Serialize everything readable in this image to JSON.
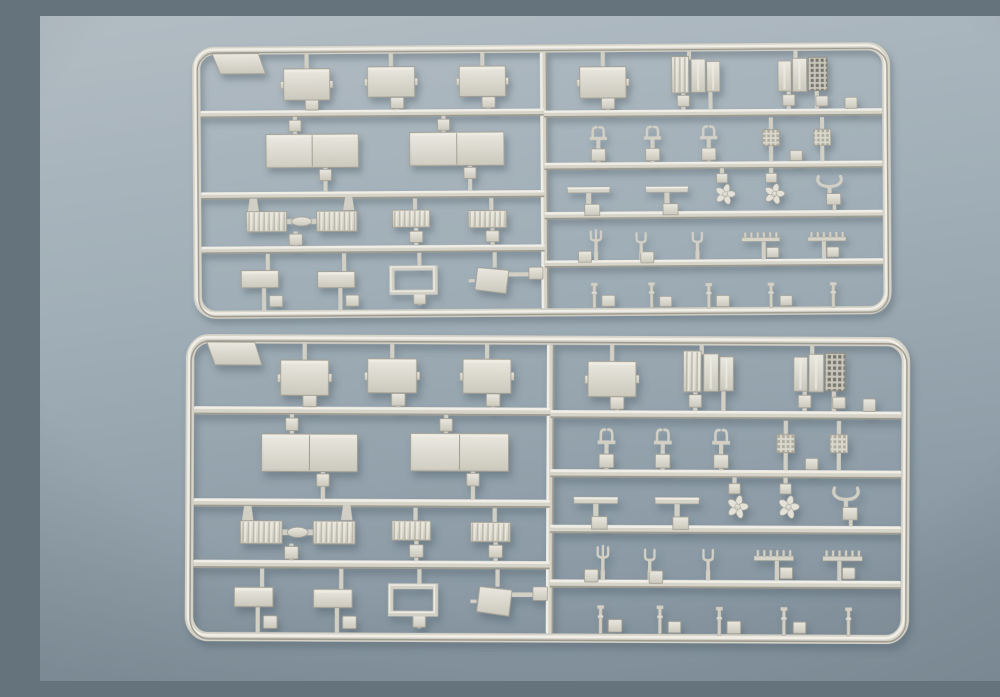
{
  "photo": {
    "alt": "Two identical light-gray injection-molded plastic model kit sprues (runners) with ship-fitting parts, lying on a blue-gray surface",
    "background": {
      "top": "#b2bcc3",
      "mid": "#a0aeb7",
      "bottom": "#8796a1"
    },
    "plastic": {
      "base": "#d6d3c8",
      "light": "#f0eee6",
      "stem": "#d2cfc4",
      "edge": "#a29f94",
      "dark": "#9e9b90",
      "panel_top": "#eae8df",
      "panel_bottom": "#cbc8bc",
      "waffle_bar": "#c9c6bb",
      "waffle_hole": "#75746c",
      "shadow": "#3f4f5c"
    },
    "sprues": [
      {
        "name": "sprue-top",
        "x": 152,
        "y": 31,
        "scaleX": 1.004,
        "scaleY": 1.007,
        "rotate": -0.4
      },
      {
        "name": "sprue-bottom",
        "x": 146,
        "y": 318,
        "scaleX": 1.042,
        "scaleY": 1.137,
        "rotate": 0.25
      }
    ],
    "layout": {
      "w": 695,
      "h": 270,
      "frameR": 18,
      "railW": 7,
      "vrailX": 350,
      "leftRails": [
        67,
        148,
        202
      ],
      "rightRails": [
        69,
        121,
        170,
        218
      ],
      "parts": [
        {
          "t": "tab"
        },
        {
          "t": "stem",
          "x": 114,
          "y1": 8,
          "y2": 23
        },
        {
          "t": "stem",
          "x": 198,
          "y1": 8,
          "y2": 21
        },
        {
          "t": "stem",
          "x": 289,
          "y1": 8,
          "y2": 22
        },
        {
          "t": "stem",
          "x": 119,
          "y1": 53,
          "y2": 64
        },
        {
          "t": "stem",
          "x": 204,
          "y1": 51,
          "y2": 64
        },
        {
          "t": "stem",
          "x": 295,
          "y1": 51,
          "y2": 64
        },
        {
          "t": "block",
          "x": 119,
          "y": 58,
          "w": 13,
          "h": 11
        },
        {
          "t": "block",
          "x": 204,
          "y": 57,
          "w": 13,
          "h": 11
        },
        {
          "t": "block",
          "x": 295,
          "y": 57,
          "w": 13,
          "h": 11
        },
        {
          "t": "panel",
          "x": 114,
          "y": 38,
          "w": 46,
          "h": 31
        },
        {
          "t": "panel",
          "x": 198,
          "y": 36,
          "w": 47,
          "h": 30
        },
        {
          "t": "panel",
          "x": 289,
          "y": 36,
          "w": 46,
          "h": 30
        },
        {
          "t": "stem",
          "x": 102,
          "y1": 70,
          "y2": 88
        },
        {
          "t": "stem",
          "x": 250,
          "y1": 70,
          "y2": 87
        },
        {
          "t": "block",
          "x": 102,
          "y": 79,
          "w": 12,
          "h": 11
        },
        {
          "t": "block",
          "x": 250,
          "y": 79,
          "w": 12,
          "h": 11
        },
        {
          "t": "dpanel",
          "x": 119,
          "y": 104,
          "w": 92,
          "h": 33
        },
        {
          "t": "dpanel",
          "x": 263,
          "y": 103,
          "w": 94,
          "h": 33
        },
        {
          "t": "stem",
          "x": 132,
          "y1": 120,
          "y2": 145
        },
        {
          "t": "stem",
          "x": 276,
          "y1": 119,
          "y2": 145
        },
        {
          "t": "block",
          "x": 132,
          "y": 128,
          "w": 12,
          "h": 11
        },
        {
          "t": "block",
          "x": 276,
          "y": 127,
          "w": 12,
          "h": 11
        },
        {
          "t": "flare",
          "x": 60,
          "y": 157
        },
        {
          "t": "flare",
          "x": 155,
          "y": 156
        },
        {
          "t": "linkbar",
          "x": 108,
          "y": 174
        },
        {
          "t": "corr",
          "x": 73,
          "y": 174,
          "w": 40,
          "h": 20
        },
        {
          "t": "corr",
          "x": 143,
          "y": 174,
          "w": 40,
          "h": 20
        },
        {
          "t": "stem",
          "x": 221,
          "y1": 152,
          "y2": 164
        },
        {
          "t": "stem",
          "x": 297,
          "y1": 152,
          "y2": 165
        },
        {
          "t": "corr",
          "x": 217,
          "y": 172,
          "w": 37,
          "h": 17
        },
        {
          "t": "corr",
          "x": 293,
          "y": 173,
          "w": 38,
          "h": 17
        },
        {
          "t": "stem",
          "x": 102,
          "y1": 184,
          "y2": 199
        },
        {
          "t": "stem",
          "x": 222,
          "y1": 181,
          "y2": 199
        },
        {
          "t": "stem",
          "x": 298,
          "y1": 182,
          "y2": 199
        },
        {
          "t": "block",
          "x": 102,
          "y": 192,
          "w": 13,
          "h": 11
        },
        {
          "t": "block",
          "x": 222,
          "y": 190,
          "w": 13,
          "h": 11
        },
        {
          "t": "block",
          "x": 298,
          "y": 190,
          "w": 13,
          "h": 11
        },
        {
          "t": "stem",
          "x": 74,
          "y1": 206,
          "y2": 223
        },
        {
          "t": "stem",
          "x": 150,
          "y1": 206,
          "y2": 224
        },
        {
          "t": "stem",
          "x": 225,
          "y1": 206,
          "y2": 221
        },
        {
          "t": "stem",
          "x": 300,
          "y1": 206,
          "y2": 221
        },
        {
          "t": "stem",
          "x": 70,
          "y1": 240,
          "y2": 262
        },
        {
          "t": "stem",
          "x": 146,
          "y1": 240,
          "y2": 262
        },
        {
          "t": "stem",
          "x": 225,
          "y1": 245,
          "y2": 258
        },
        {
          "t": "block",
          "x": 82,
          "y": 253,
          "w": 13,
          "h": 11
        },
        {
          "t": "block",
          "x": 158,
          "y": 253,
          "w": 13,
          "h": 11
        },
        {
          "t": "block",
          "x": 225,
          "y": 252,
          "w": 12,
          "h": 10
        },
        {
          "t": "panel",
          "x": 66,
          "y": 231,
          "w": 37,
          "h": 17
        },
        {
          "t": "panel",
          "x": 142,
          "y": 232,
          "w": 37,
          "h": 16
        },
        {
          "t": "openrect",
          "x": 219,
          "y": 233,
          "w": 43,
          "h": 24
        },
        {
          "t": "hstem",
          "y": 228,
          "x1": 312,
          "x2": 344
        },
        {
          "t": "block",
          "x": 341,
          "y": 227,
          "w": 14,
          "h": 12
        },
        {
          "t": "trap",
          "x": 297,
          "y": 234,
          "w": 34,
          "h": 26
        },
        {
          "t": "stem",
          "x": 409,
          "y1": 8,
          "y2": 23
        },
        {
          "t": "stem",
          "x": 414,
          "y1": 53,
          "y2": 66
        },
        {
          "t": "block",
          "x": 414,
          "y": 59,
          "w": 13,
          "h": 11
        },
        {
          "t": "panel",
          "x": 409,
          "y": 38,
          "w": 46,
          "h": 31
        },
        {
          "t": "stem",
          "x": 495,
          "y1": 8,
          "y2": 16
        },
        {
          "t": "stem",
          "x": 601,
          "y1": 8,
          "y2": 16
        },
        {
          "t": "stem",
          "x": 489,
          "y1": 49,
          "y2": 66
        },
        {
          "t": "block",
          "x": 489,
          "y": 57,
          "w": 12,
          "h": 11
        },
        {
          "t": "stem",
          "x": 516,
          "y1": 48,
          "y2": 66
        },
        {
          "t": "stem",
          "x": 594,
          "y1": 48,
          "y2": 66
        },
        {
          "t": "block",
          "x": 594,
          "y": 57,
          "w": 12,
          "h": 11
        },
        {
          "t": "stem",
          "x": 622,
          "y1": 48,
          "y2": 66
        },
        {
          "t": "block",
          "x": 627,
          "y": 58,
          "w": 12,
          "h": 10
        },
        {
          "t": "corr",
          "x": 486,
          "y": 31,
          "w": 17,
          "h": 36
        },
        {
          "t": "slat",
          "x": 504,
          "y": 32,
          "w": 14,
          "h": 33
        },
        {
          "t": "slat",
          "x": 519,
          "y": 33,
          "w": 13,
          "h": 30
        },
        {
          "t": "slat",
          "x": 590,
          "y": 33,
          "w": 13,
          "h": 30
        },
        {
          "t": "slat",
          "x": 605,
          "y": 32,
          "w": 14,
          "h": 33
        },
        {
          "t": "waffle",
          "x": 623,
          "y": 31,
          "w": 19,
          "h": 33
        },
        {
          "t": "block",
          "x": 656,
          "y": 60,
          "w": 12,
          "h": 11
        },
        {
          "t": "stem",
          "x": 404,
          "y1": 100,
          "y2": 118
        },
        {
          "t": "stem",
          "x": 458,
          "y1": 100,
          "y2": 118
        },
        {
          "t": "stem",
          "x": 514,
          "y1": 100,
          "y2": 118
        },
        {
          "t": "block",
          "x": 404,
          "y": 110,
          "w": 14,
          "h": 12
        },
        {
          "t": "block",
          "x": 458,
          "y": 110,
          "w": 14,
          "h": 12
        },
        {
          "t": "block",
          "x": 514,
          "y": 110,
          "w": 14,
          "h": 12
        },
        {
          "t": "davit",
          "x": 404,
          "y": 90
        },
        {
          "t": "davit",
          "x": 458,
          "y": 90
        },
        {
          "t": "davit",
          "x": 514,
          "y": 90
        },
        {
          "t": "stem",
          "x": 576,
          "y1": 74,
          "y2": 86
        },
        {
          "t": "stem",
          "x": 576,
          "y1": 102,
          "y2": 118
        },
        {
          "t": "gridsq",
          "x": 576,
          "y": 94,
          "w": 17,
          "h": 16
        },
        {
          "t": "stem",
          "x": 627,
          "y1": 74,
          "y2": 86
        },
        {
          "t": "stem",
          "x": 627,
          "y1": 102,
          "y2": 118
        },
        {
          "t": "gridsq",
          "x": 627,
          "y": 94,
          "w": 17,
          "h": 16
        },
        {
          "t": "block",
          "x": 601,
          "y": 112,
          "w": 12,
          "h": 10
        },
        {
          "t": "ttable",
          "x": 394,
          "y": 151
        },
        {
          "t": "ttable",
          "x": 472,
          "y": 151
        },
        {
          "t": "stem",
          "x": 527,
          "y1": 124,
          "y2": 131
        },
        {
          "t": "block",
          "x": 527,
          "y": 134,
          "w": 11,
          "h": 9
        },
        {
          "t": "stem",
          "x": 576,
          "y1": 124,
          "y2": 131
        },
        {
          "t": "block",
          "x": 576,
          "y": 134,
          "w": 11,
          "h": 9
        },
        {
          "t": "prop",
          "x": 530,
          "y": 150
        },
        {
          "t": "prop",
          "x": 579,
          "y": 150
        },
        {
          "t": "ubracket",
          "x": 634,
          "y": 142
        },
        {
          "t": "stem",
          "x": 401,
          "y1": 206,
          "y2": 215
        },
        {
          "t": "block",
          "x": 390,
          "y": 211,
          "w": 13,
          "h": 11
        },
        {
          "t": "trident",
          "x": 401,
          "y": 196
        },
        {
          "t": "stem",
          "x": 446,
          "y1": 206,
          "y2": 215
        },
        {
          "t": "block",
          "x": 452,
          "y": 212,
          "w": 13,
          "h": 11
        },
        {
          "t": "fork",
          "x": 446,
          "y": 198
        },
        {
          "t": "stem",
          "x": 502,
          "y1": 206,
          "y2": 215
        },
        {
          "t": "fork",
          "x": 502,
          "y": 198
        },
        {
          "t": "stem",
          "x": 568,
          "y1": 197,
          "y2": 215
        },
        {
          "t": "block",
          "x": 577,
          "y": 208,
          "w": 12,
          "h": 10
        },
        {
          "t": "comb",
          "x": 565,
          "y": 193,
          "w": 38
        },
        {
          "t": "stem",
          "x": 628,
          "y1": 197,
          "y2": 215
        },
        {
          "t": "block",
          "x": 637,
          "y": 208,
          "w": 12,
          "h": 10
        },
        {
          "t": "comb",
          "x": 631,
          "y": 193,
          "w": 38
        },
        {
          "t": "stanchion",
          "x": 399,
          "y": 250
        },
        {
          "t": "block",
          "x": 413,
          "y": 255,
          "w": 13,
          "h": 11
        },
        {
          "t": "stanchion",
          "x": 456,
          "y": 250
        },
        {
          "t": "block",
          "x": 470,
          "y": 256,
          "w": 12,
          "h": 10
        },
        {
          "t": "stanchion",
          "x": 513,
          "y": 251
        },
        {
          "t": "block",
          "x": 527,
          "y": 256,
          "w": 13,
          "h": 11
        },
        {
          "t": "stanchion",
          "x": 575,
          "y": 251
        },
        {
          "t": "block",
          "x": 590,
          "y": 256,
          "w": 12,
          "h": 10
        },
        {
          "t": "stanchion",
          "x": 637,
          "y": 251
        }
      ]
    }
  }
}
